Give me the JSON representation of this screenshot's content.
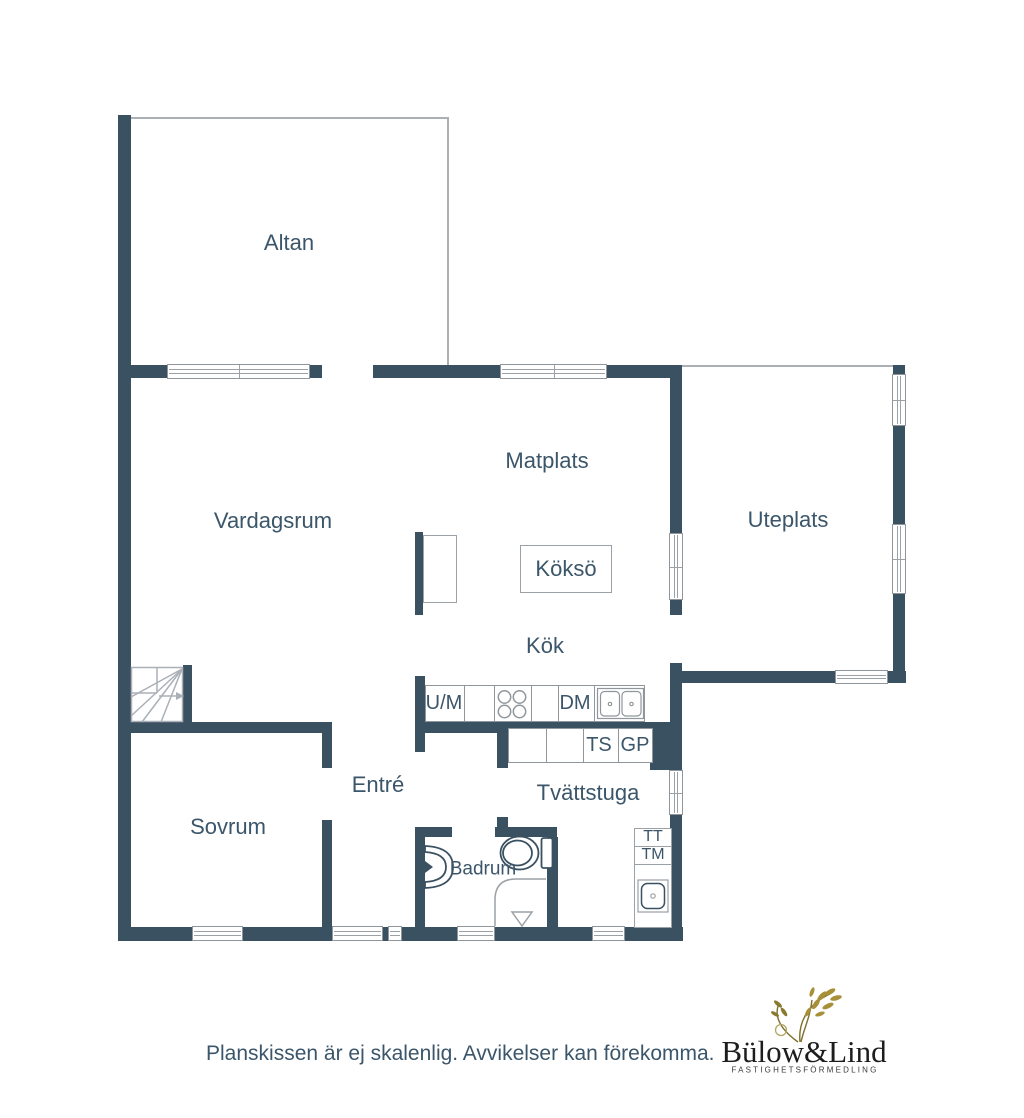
{
  "colors": {
    "wall": "#3a5162",
    "room_text": "#3b566a",
    "thin_line": "#9aa1a7",
    "logo_text": "#1d1d1d",
    "logo_plant_gold": "#a89038",
    "logo_plant_olive": "#7d712c"
  },
  "rooms": {
    "altan": "Altan",
    "vardagsrum": "Vardagssrum",
    "matplats": "Matplats",
    "uteplats": "Uteplats",
    "kokso": "Köksö",
    "kok": "Kök",
    "entre": "Entré",
    "tvattstuga": "Tvättstuga",
    "sovrum": "Sovrum",
    "badrum": "Badrum"
  },
  "appliances": {
    "um": "U/M",
    "dm": "DM",
    "ts": "TS",
    "gp": "GP",
    "tt": "TT",
    "tm": "TM"
  },
  "footer": {
    "disclaimer": "Planskissen är ej skalenlig. Avvikelser kan förekomma.",
    "brand": "Bülow&Lind",
    "brand_sub": "FASTIGHETSFÖRMEDLING"
  }
}
